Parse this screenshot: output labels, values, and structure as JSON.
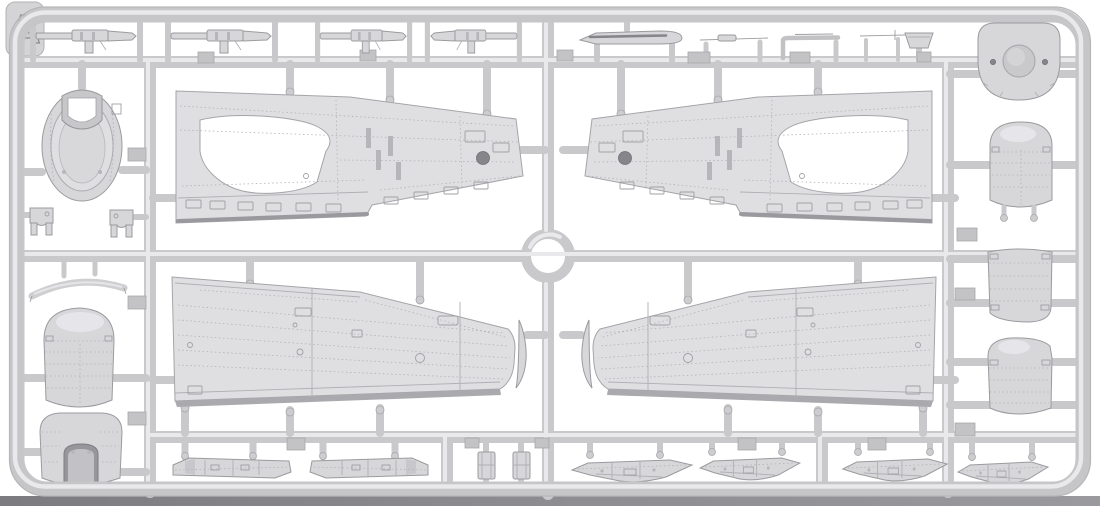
{
  "sprue": {
    "label": "A",
    "kind": "injection-molded-model-kit-sprue",
    "subject": "aircraft wing and engine-cowling parts frame",
    "parts": [
      {
        "name": "machine-gun",
        "qty": 4,
        "area": "top-left"
      },
      {
        "name": "gun-barrel-blade",
        "qty": 1,
        "area": "top-center"
      },
      {
        "name": "pitot-tube",
        "qty": 2,
        "area": "top-right"
      },
      {
        "name": "l-shaped-pipe",
        "qty": 1,
        "area": "top-right"
      },
      {
        "name": "intake-scoop",
        "qty": 1,
        "area": "top-right"
      },
      {
        "name": "engine-bulkhead-disc",
        "qty": 1,
        "area": "right-column"
      },
      {
        "name": "cowling-nose-ring",
        "qty": 1,
        "area": "left-column"
      },
      {
        "name": "hinge-bracket",
        "qty": 2,
        "area": "left-column"
      },
      {
        "name": "cowl-lip-segment",
        "qty": 1,
        "area": "left-column"
      },
      {
        "name": "cowling-dome-panel",
        "qty": 2,
        "area": "left-and-right-columns"
      },
      {
        "name": "cowling-bottom-panel",
        "qty": 1,
        "area": "left-column"
      },
      {
        "name": "cowling-side-panel",
        "qty": 2,
        "area": "right-column"
      },
      {
        "name": "upper-wing-half",
        "qty": 2,
        "area": "upper-center"
      },
      {
        "name": "lower-wing-half",
        "qty": 2,
        "area": "lower-center"
      },
      {
        "name": "wingtip-insert",
        "qty": 2,
        "area": "lower-center"
      },
      {
        "name": "wheel-bay-door",
        "qty": 2,
        "area": "bottom-left"
      },
      {
        "name": "radiator-block",
        "qty": 2,
        "area": "bottom-center"
      },
      {
        "name": "cowl-flap-strip",
        "qty": 4,
        "area": "bottom-right"
      }
    ]
  },
  "colors": {
    "background": "#ffffff",
    "plastic_base": "#d6d6d9",
    "plastic_light": "#e9e9eb",
    "frame": "#c9c9cc",
    "outline": "#9b9b9f",
    "detail_line": "#b2b2b6",
    "dark_detail": "#85858a",
    "ground_shadow": "#84848a"
  }
}
